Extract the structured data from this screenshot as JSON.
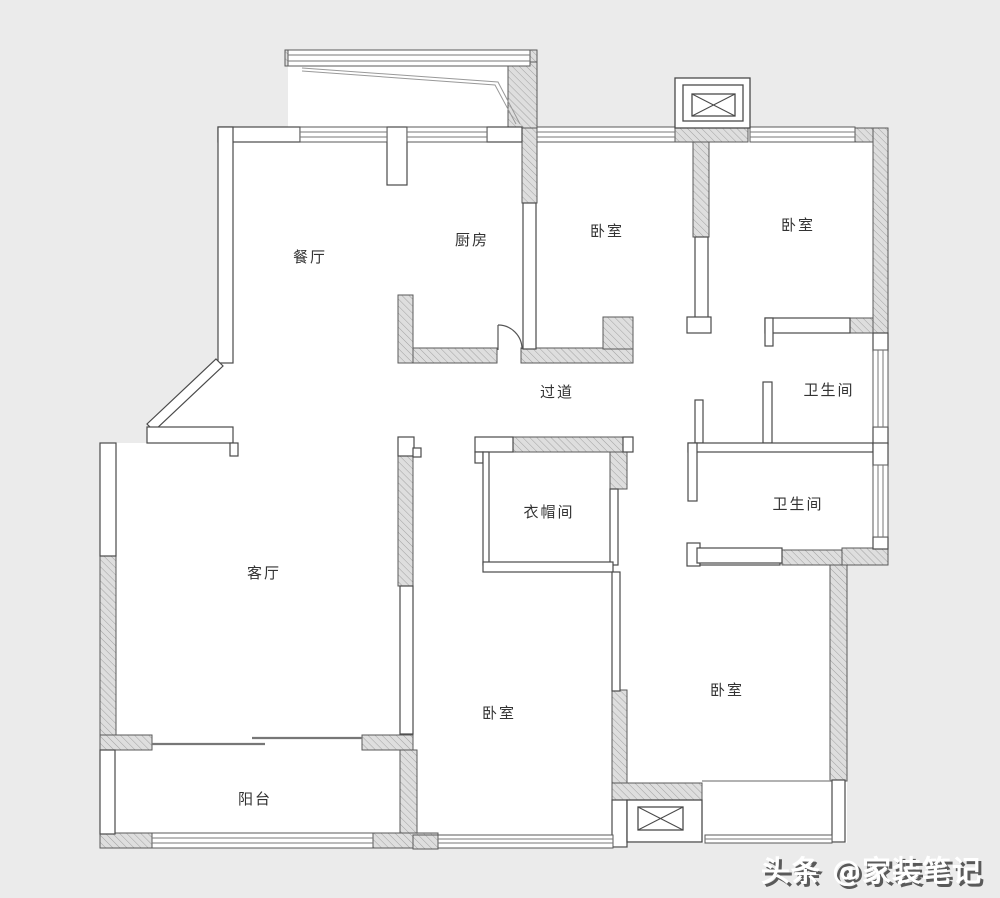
{
  "rooms": {
    "dining": {
      "label": "餐厅"
    },
    "kitchen": {
      "label": "厨房"
    },
    "bedroom_top_middle": {
      "label": "卧室"
    },
    "bedroom_top_right": {
      "label": "卧室"
    },
    "hallway": {
      "label": "过道"
    },
    "bathroom_top": {
      "label": "卫生间"
    },
    "cloakroom": {
      "label": "衣帽间"
    },
    "bathroom_bottom": {
      "label": "卫生间"
    },
    "living": {
      "label": "客厅"
    },
    "bedroom_bottom_middle": {
      "label": "卧室"
    },
    "bedroom_bottom_right": {
      "label": "卧室"
    },
    "balcony": {
      "label": "阳台"
    }
  },
  "watermark": {
    "text": "头条 @家装笔记"
  },
  "colors": {
    "background": "#ebebeb",
    "floor": "#ffffff",
    "wall_line": "#4a4a4a",
    "watermark_shadow": "#5a5a5a"
  }
}
